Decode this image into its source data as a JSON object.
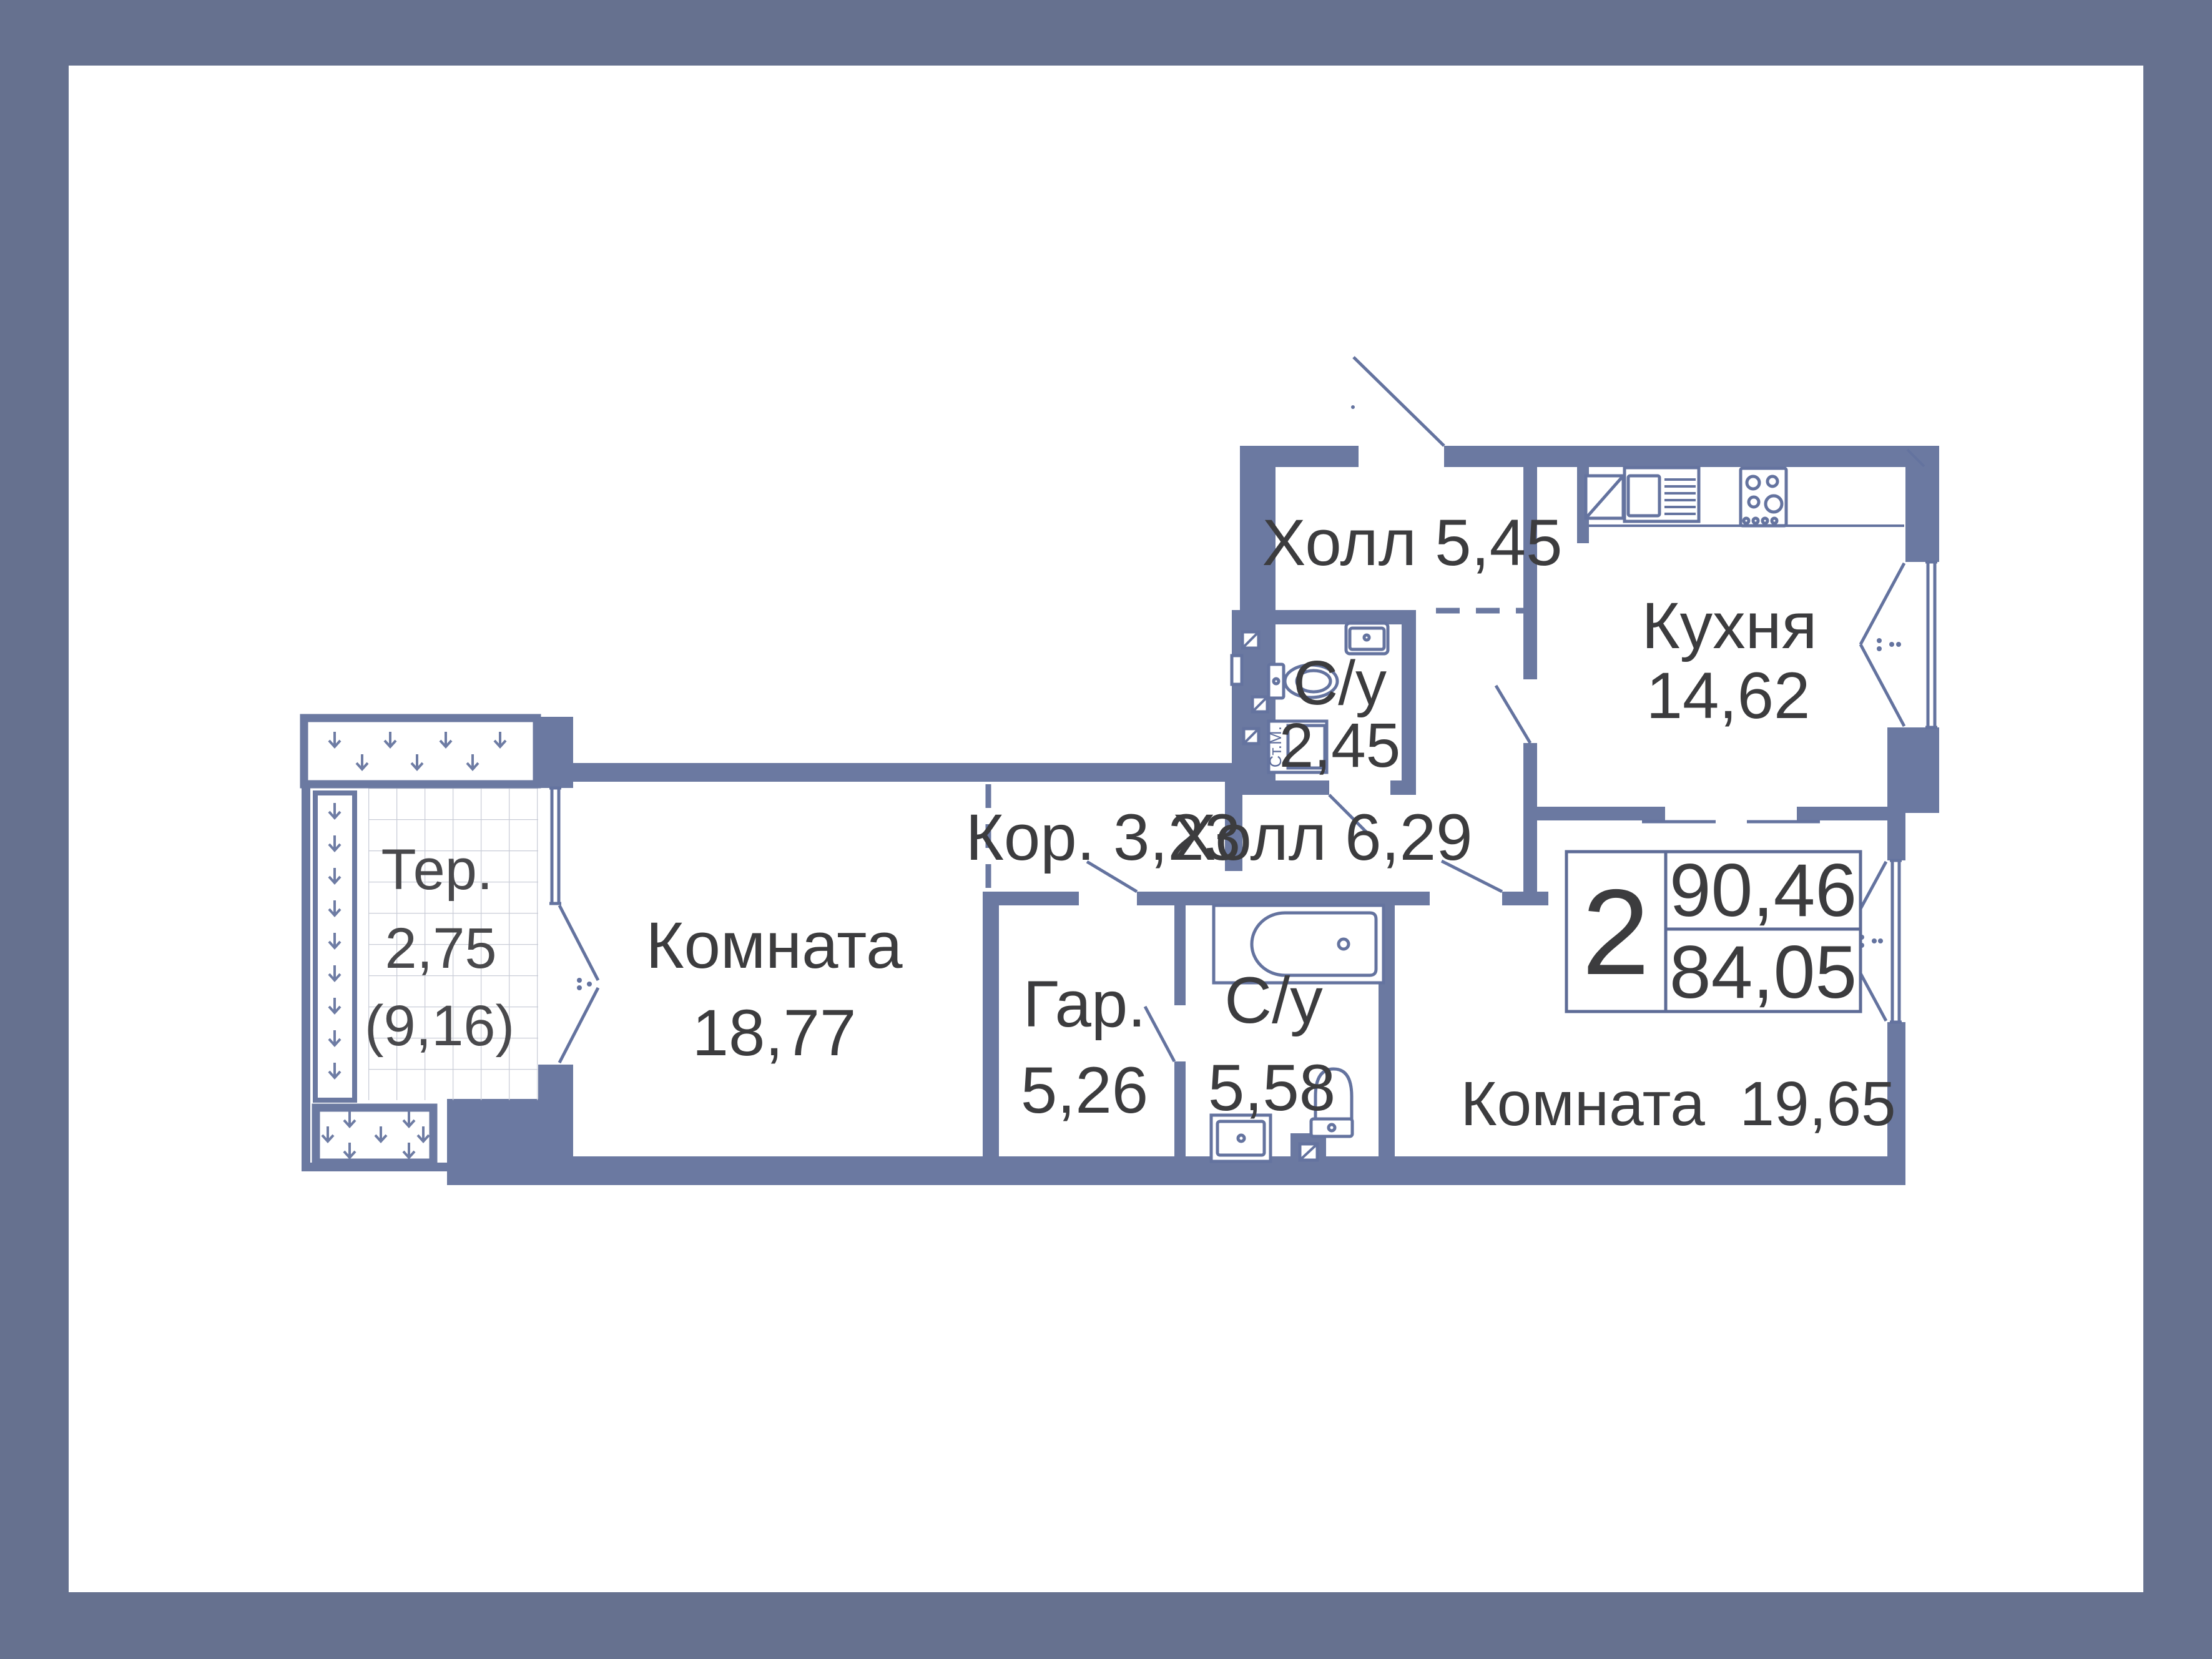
{
  "plan": {
    "type": "apartment-floor-plan",
    "language": "ru",
    "summary": {
      "rooms_count": "2",
      "total_area": "90,46",
      "living_area": "84,05"
    },
    "rooms": [
      {
        "name": "Холл",
        "area": "5,45"
      },
      {
        "name": "Кухня",
        "area": "14,62"
      },
      {
        "name": "С/у",
        "area": "2,45"
      },
      {
        "name": "Холл",
        "area": "6,29"
      },
      {
        "name": "Кор.",
        "area": "3,23"
      },
      {
        "name": "Комната",
        "area": "18,77"
      },
      {
        "name": "Тер.",
        "area": "2,75",
        "area_in_brackets": "(9,16)"
      },
      {
        "name": "Гар.",
        "area": "5,26"
      },
      {
        "name": "С/у",
        "area": "5,58"
      },
      {
        "name": "Комната",
        "area": "19,65"
      }
    ],
    "labels": {
      "hall545": "Холл 5,45",
      "kitchen_name": "Кухня",
      "kitchen_area": "14,62",
      "su245_name": "С/у",
      "su245_area": "2,45",
      "hall629": "Холл 6,29",
      "cor323": "Кор. 3,23",
      "room1_name": "Комната",
      "room1_area": "18,77",
      "ter_name": "Тер.",
      "ter_area": "2,75",
      "ter_area_full": "(9,16)",
      "gar_name": "Гар.",
      "gar_area": "5,26",
      "su558_name": "С/у",
      "su558_area": "5,58",
      "room2_full": "Комната  19,65",
      "washer": "Ст.М.",
      "info_rooms": "2",
      "info_total": "90,46",
      "info_living": "84,05"
    },
    "fixtures": [
      "kitchen-sink-icon",
      "dish-rack-icon",
      "stove-icon",
      "bathtub-icon",
      "toilet-icon",
      "washbasin-icon",
      "washing-machine-icon",
      "vent-shaft-icon",
      "planter-icon",
      "tiled-floor",
      "window",
      "door-swing"
    ],
    "colors": {
      "frame": "#66718f",
      "wall": "#6b79a1",
      "thin_line": "#64739f",
      "text": "#3c3c3e",
      "terrace_text": "#49494c",
      "tile_grid": "#c9cdd7",
      "background": "#ffffff"
    }
  }
}
